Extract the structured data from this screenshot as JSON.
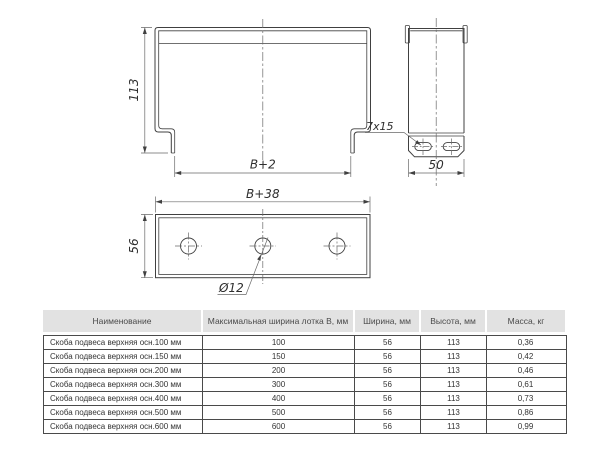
{
  "drawing": {
    "front_view": {
      "height_label": "113",
      "width_label": "B+2",
      "slot_label": "7x15"
    },
    "side_view": {
      "width_label": "50"
    },
    "plan_view": {
      "width_label": "B+38",
      "depth_label": "56",
      "hole_label": "Ø12"
    },
    "colors": {
      "outline": "#404040",
      "thin_line": "#6a6a6a",
      "text": "#2e2e2e"
    }
  },
  "table": {
    "headers": [
      "Наименование",
      "Максимальная ширина лотка В, мм",
      "Ширина, мм",
      "Высота, мм",
      "Масса, кг"
    ],
    "rows": [
      {
        "name": "Скоба подвеса верхняя осн.100 мм",
        "b": "100",
        "w": "56",
        "h": "113",
        "m": "0,36"
      },
      {
        "name": "Скоба подвеса верхняя осн.150 мм",
        "b": "150",
        "w": "56",
        "h": "113",
        "m": "0,42"
      },
      {
        "name": "Скоба подвеса верхняя осн.200 мм",
        "b": "200",
        "w": "56",
        "h": "113",
        "m": "0,46"
      },
      {
        "name": "Скоба подвеса верхняя осн.300 мм",
        "b": "300",
        "w": "56",
        "h": "113",
        "m": "0,61"
      },
      {
        "name": "Скоба подвеса верхняя осн.400 мм",
        "b": "400",
        "w": "56",
        "h": "113",
        "m": "0,73"
      },
      {
        "name": "Скоба подвеса верхняя осн.500 мм",
        "b": "500",
        "w": "56",
        "h": "113",
        "m": "0,86"
      },
      {
        "name": "Скоба подвеса верхняя осн.600 мм",
        "b": "600",
        "w": "56",
        "h": "113",
        "m": "0,99"
      }
    ]
  }
}
